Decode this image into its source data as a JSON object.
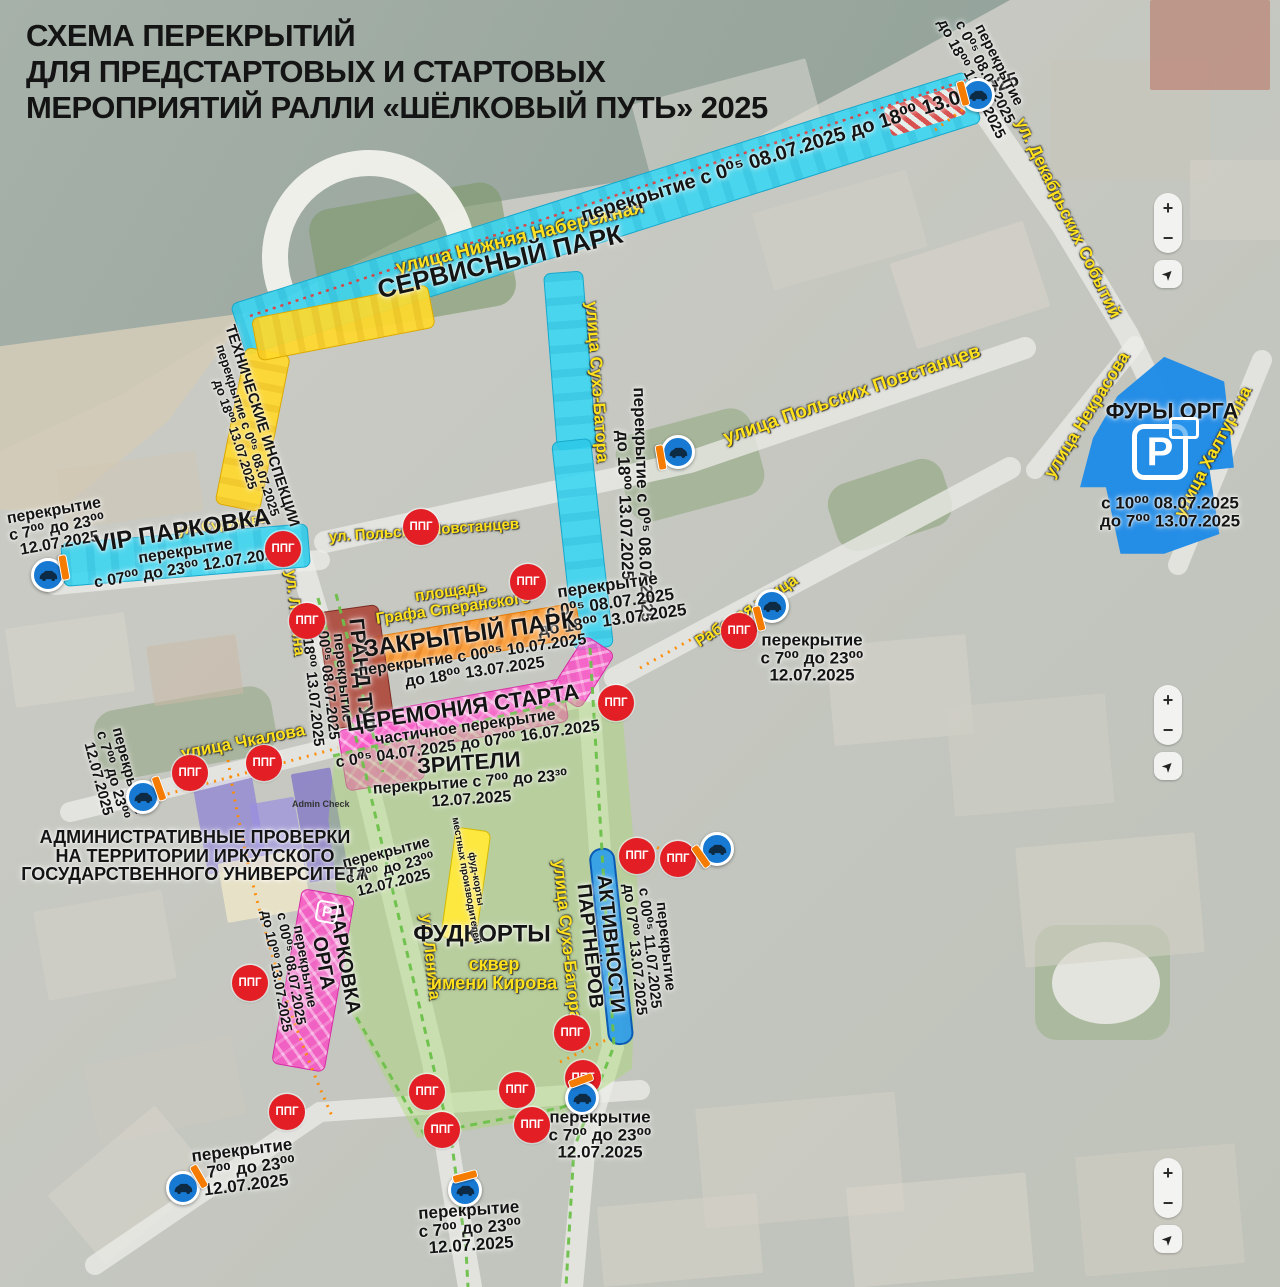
{
  "title": {
    "lines": [
      "СХЕМА ПЕРЕКРЫТИЙ",
      "ДЛЯ ПРЕДСТАРТОВЫХ И СТАРТОВЫХ",
      "МЕРОПРИЯТИЙ РАЛЛИ «ШЁЛКОВЫЙ ПУТЬ» 2025"
    ]
  },
  "streets": {
    "nizhnyaya_naberezhnaya": "улица Нижняя Набережная",
    "dekabrskikh_sobytiy": "ул. Декабрьских Событий",
    "sukhe_batora_north": "улица Сухэ-Батора",
    "sukhe_batora_south": "улица Сухэ-Батора",
    "polskikh_povstantsev": "улица Польских Повстанцев",
    "polskikh_povstantsev_small": "ул. Польских Повстанцев",
    "rabochaya": "Рабочая улица",
    "surikova": "ул. Сурикова",
    "lenina_north": "ул. Ленина",
    "lenina_south": "ул. Ленина",
    "chkalova": "улица Чкалова",
    "nekrasova": "улица Некрасова",
    "khalturina": "улица Халтурина",
    "speranskogo": {
      "lines": [
        "площадь",
        "Графа Сперанского"
      ]
    },
    "kirova": {
      "lines": [
        "сквер",
        "имени Кирова"
      ]
    }
  },
  "zones": {
    "service_park": {
      "title": "СЕРВИСНЫЙ ПАРК",
      "closure": "перекрытие с 0⁰⁵ 08.07.2025 до 18⁰⁰ 13.07.2025"
    },
    "dekabrskikh_closure": {
      "lines": [
        "перекрытие",
        "с 0⁰⁵ 08.07.2025",
        "до 18⁰⁰ 13.07.2025"
      ]
    },
    "sukhe_batora_closure": {
      "lines": [
        "перекрытие с 0⁰⁵ 08.07.2025",
        "до 18⁰⁰ 13.07.2025"
      ]
    },
    "center_closure": {
      "lines": [
        "перекрытие",
        "с 0⁰⁵ 08.07.2025",
        "до 18⁰⁰ 13.07.2025"
      ]
    },
    "tech_inspection": {
      "title": "ТЕХНИЧЕСКИЕ ИНСПЕКЦИИ",
      "lines": [
        "перекрытие с 0⁰⁵ 08.07.2025",
        "до 18⁰⁰ 13.07.2025"
      ]
    },
    "vip_parking": {
      "title": "VIP ПАРКОВКА",
      "lines": [
        "перекрытие",
        "с 07⁰⁰ до 23⁰⁰ 12.07.2025"
      ]
    },
    "grand_tour": {
      "title": "ГРАНД ТУР",
      "lines": [
        "перекрытие",
        "с 00⁰⁵ 08.07.2025",
        "до 18⁰⁰ 13.07.2025"
      ]
    },
    "closed_park": {
      "title": "ЗАКРЫТЫЙ ПАРК",
      "lines": [
        "перекрытие с 00⁰⁵ 10.07.2025",
        "до 18⁰⁰ 13.07.2025"
      ]
    },
    "start_ceremony": {
      "title": "ЦЕРЕМОНИЯ СТАРТА",
      "lines": [
        "частичное перекрытие",
        "с 0⁰⁵ 04.07.2025 до 07⁰⁰ 16.07.2025"
      ]
    },
    "spectators": {
      "title": "ЗРИТЕЛИ",
      "lines": [
        "перекрытие с 7⁰⁰ до 23³⁰",
        "12.07.2025"
      ]
    },
    "admin_checks": {
      "lines": [
        "АДМИНИСТРАТИВНЫЕ ПРОВЕРКИ",
        "НА ТЕРРИТОРИИ ИРКУТСКОГО",
        "ГОСУДАРСТВЕННОГО УНИВЕРСИТЕТА"
      ],
      "building_tag": "Admin Check"
    },
    "parking_orga": {
      "title_lines": [
        "ПАРКОВКА",
        "ОРГА"
      ],
      "lines": [
        "перекрытие",
        "с 00⁰⁵ 08.07.2025",
        "до 10⁰⁰ 13.07.2025"
      ]
    },
    "foodcourts": {
      "title": "ФУДКОРТЫ",
      "strip_lines": [
        "фуд-корты",
        "местных производителей"
      ]
    },
    "partners": {
      "title_lines": [
        "АКТИВНОСТИ",
        "ПАРТНЁРОВ"
      ],
      "lines": [
        "перекрытие",
        "с 00⁰⁵ 11.07.2025",
        "до 07⁰⁰ 13.07.2025"
      ]
    },
    "fury_orga": {
      "title": "ФУРЫ ОРГА",
      "lines": [
        "с 10⁰⁰ 08.07.2025",
        "до 7⁰⁰ 13.07.2025"
      ]
    },
    "closure_7_23": {
      "lines": [
        "перекрытие",
        "с 7⁰⁰ до 23⁰⁰",
        "12.07.2025"
      ]
    }
  },
  "icons": {
    "ppg": "ППГ",
    "parking": "P",
    "locate": "➤"
  },
  "controls": {
    "zoom_in": "+",
    "zoom_out": "−"
  },
  "colors": {
    "road_closed_cyan": "#38d6f3",
    "tech_yellow": "#ffd92b",
    "closed_park_orange": "#ff9828",
    "ceremony_pink": "#fc5cce",
    "grand_tour_red": "#ac3f32",
    "partners_blue": "#2d9ce8",
    "fury_orga_blue": "#2494ee",
    "spectators_green": "#a8d86e",
    "ppg_red": "#e31e24",
    "sign_blue": "#1879d2",
    "barrier_orange": "#f57c00",
    "street_label_yellow": "#ffe11c"
  }
}
